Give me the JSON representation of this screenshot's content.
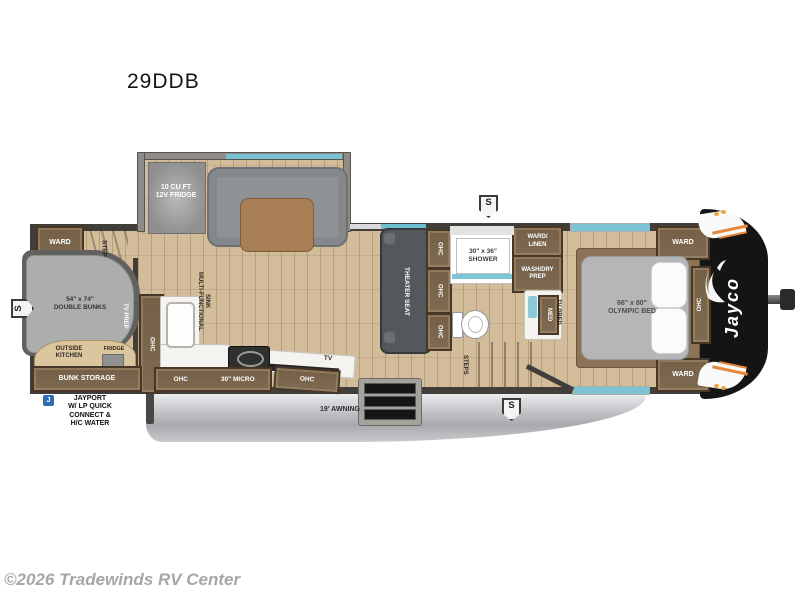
{
  "title": "29DDB",
  "copyright": "©2026 Tradewinds RV Center",
  "badges": {
    "speaker": "S",
    "jayport_icon": "J"
  },
  "brand": {
    "logo": "Jayco"
  },
  "exterior": {
    "awning": "19' AWNING",
    "jayport": "JAYPORT\nW/ LP QUICK\nCONNECT &\nH/C WATER",
    "bunk_storage": "BUNK STORAGE"
  },
  "bunk_room": {
    "ward": "WARD",
    "steps": "STEPS",
    "bunks": "54\" x 74\"\nDOUBLE BUNKS",
    "tv_prep": "TV PREP",
    "outside_kitchen": "OUTSIDE\nKITCHEN",
    "fridge": "FRIDGE"
  },
  "kitchen": {
    "fridge12v": "10 CU FT\n12V FRIDGE",
    "pantry_ohc": "OHC",
    "sink": "MULTI-FUNCTIONAL\nSINK",
    "ohc": "OHC",
    "micro": "30\" MICRO",
    "tv": "TV",
    "ohc_right": "OHC"
  },
  "living": {
    "theater_seat": "THEATER SEAT",
    "ohc1": "OHC",
    "ohc2": "OHC",
    "ohc3": "OHC"
  },
  "bath": {
    "shower": "30\" x 36\"\nSHOWER",
    "ward_linen": "WARD/\nLINEN",
    "wash_dry": "WASH/DRY\nPREP",
    "med": "MED",
    "steps": "STEPS"
  },
  "bedroom": {
    "tv_prep": "TV PREP",
    "bed": "66\" x 80\"\nOLYMPIC BED",
    "ohc": "OHC",
    "ward_top": "WARD",
    "ward_bottom": "WARD"
  }
}
